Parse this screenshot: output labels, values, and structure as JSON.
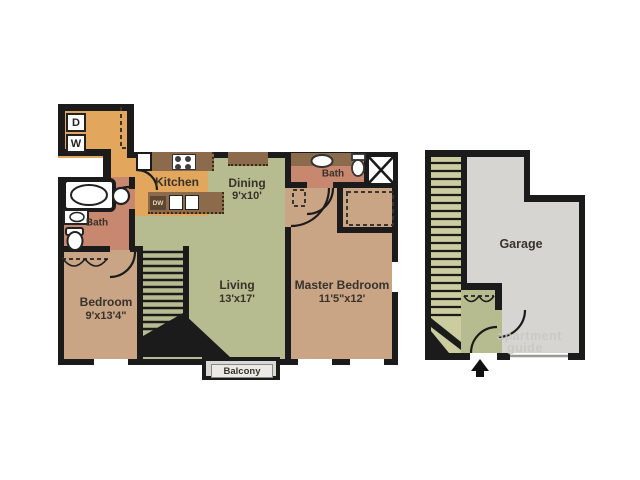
{
  "floorplan": {
    "apartment": {
      "laundry": {
        "dryer": "D",
        "washer": "W"
      },
      "kitchen": {
        "label": "Kitchen",
        "dishwasher": "DW"
      },
      "dining": {
        "label": "Dining",
        "dims": "9'x10'"
      },
      "living": {
        "label": "Living",
        "dims": "13'x17'"
      },
      "master_bedroom": {
        "label": "Master Bedroom",
        "dims": "11'5\"x12'"
      },
      "bedroom": {
        "label": "Bedroom",
        "dims": "9'x13'4\""
      },
      "bath_main": {
        "label": "Bath"
      },
      "bath_master": {
        "label": "Bath"
      },
      "balcony": {
        "label": "Balcony"
      }
    },
    "garage_unit": {
      "garage": {
        "label": "Garage"
      }
    },
    "watermark": {
      "line1": "apartment",
      "line2": "guide"
    },
    "colors": {
      "wall": "#1b1b1b",
      "kitchen_orange": "#e2a65c",
      "living_green": "#b7bc90",
      "bedroom_tan": "#c9a585",
      "bath_salmon": "#c8876f",
      "counter_brown": "#8b6b4c",
      "garage_gray": "#d6d5d1",
      "garage_stairs_green": "#cbcc9f",
      "balcony_gray": "#d8d8d4"
    }
  }
}
